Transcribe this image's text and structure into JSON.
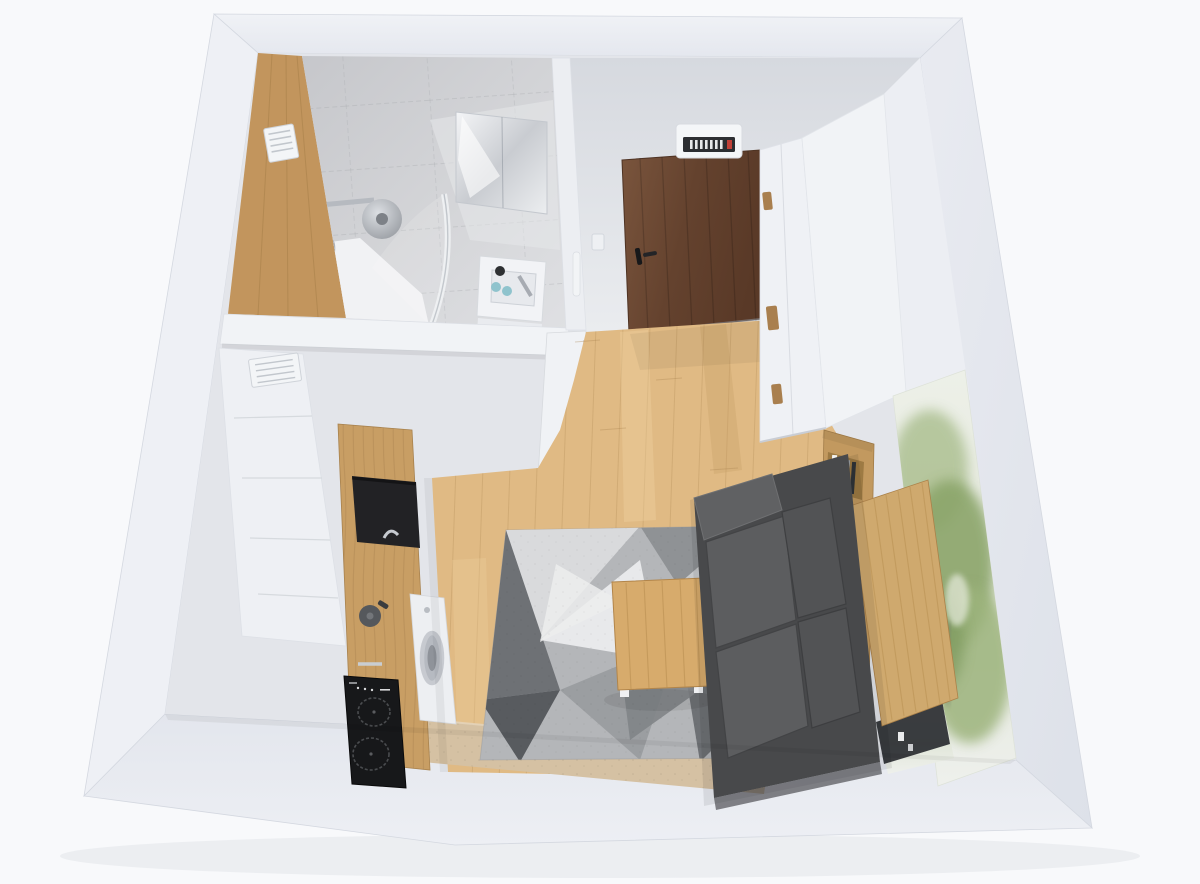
{
  "scene": {
    "type": "3d-floorplan-render",
    "view": "top-down cutaway of a studio apartment",
    "rooms": [
      "bathroom",
      "entry-hall",
      "kitchen",
      "living-room"
    ]
  },
  "colors": {
    "background": "#f8f9fb",
    "page_shadow": "#e9ebef",
    "interior_base": "#e3e5ea",
    "wall_north": "#eaecf1",
    "wall_east": "#e3e6ed",
    "wall_south": "#e7e9ef",
    "wall_west": "#eef0f5",
    "wall_edge": "#d4d8e0",
    "bath_wood_wall": "#c2955d",
    "bath_tile": "#cbccd0",
    "bath_tile_light": "#dedfe2",
    "mirror_cabinet": "#e9ebee",
    "shower_chrome": "#b6bac0",
    "shower_head": "#a7abb1",
    "shower_tray": "#f1f2f4",
    "vanity_top": "#f2f3f6",
    "sink_basin": "#e7e9ed",
    "toiletry_dark": "#2e3033",
    "toiletry_teal": "#8fc3cd",
    "divider_wall": "#f1f3f6",
    "hall_wall": "#dcdfe5",
    "entry_door": "#6d4934",
    "door_handle": "#17181a",
    "fusebox_body": "#f4f6f8",
    "fusebox_strip": "#2c2e32",
    "fusebox_red": "#c04038",
    "switch_white": "#eef0f3",
    "bath_door_white": "#f0f2f5",
    "floor_oak": "#e0ba84",
    "floor_seam": "#a9844f",
    "wardrobe_front": "#eff1f5",
    "wardrobe_side": "#f1f3f6",
    "wardrobe_slot": "#a97f4e",
    "right_wall_patch": "#eceef3",
    "mural_base": "#e7ebe0",
    "mural_green_1": "#a9bd8d",
    "mural_green_2": "#8ba56b",
    "mural_green_3": "#9cb37c",
    "mural_green_dark": "#7e9a5f",
    "sill_beige": "#d5c1a3",
    "rug_base": "#b4b6b9",
    "rug_light": "#d9dadc",
    "rug_white": "#e8e9eb",
    "rug_mid": "#8f9295",
    "rug_dark": "#6e7175",
    "rug_charcoal": "#585b5f",
    "table_wood": "#d7ab6c",
    "sofa_chassis": "#48494b",
    "sofa_arm": "#606163",
    "sofa_seat": "#5c5d5f",
    "sofa_back": "#525355",
    "shelf_wood": "#c2995f",
    "shelf_inner": "#97753f",
    "desk_wood": "#cfa96e",
    "under_desk_dark": "#2a2d31",
    "kitchen_cab_white": "#eef0f4",
    "counter_wood": "#c89e64",
    "niche_black": "#222225",
    "cooktop_black": "#17181a",
    "burner_ring": "#4a4c4f",
    "washer_white": "#edeff2",
    "washer_ring": "#c7cad0",
    "moka_gray": "#55585c",
    "vent_white": "#f3f5f7"
  }
}
